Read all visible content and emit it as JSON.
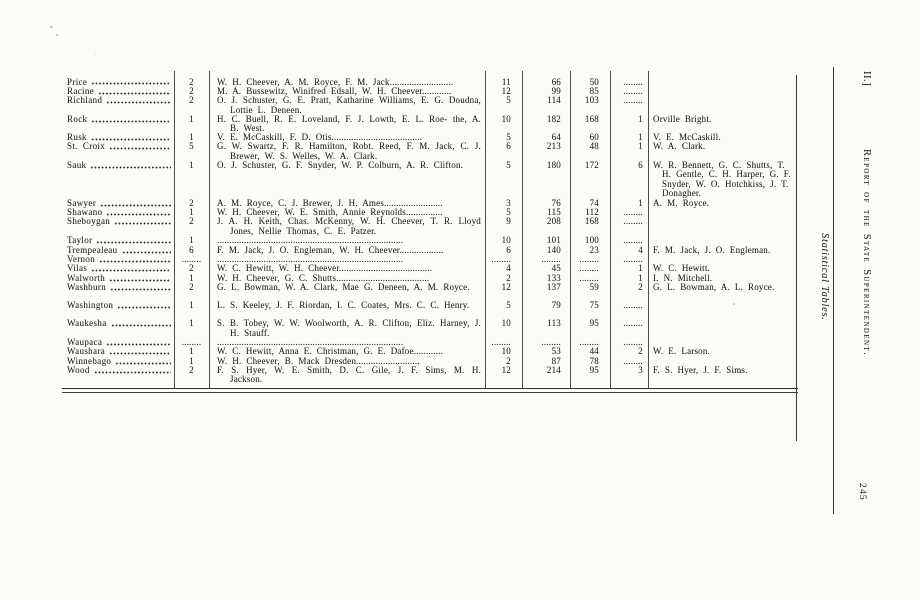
{
  "sidebar": {
    "volume_label": "II.]",
    "running_title": "Report of the State Superintendent.",
    "section_title": "Statistical Tables.",
    "page_number": "245"
  },
  "table": {
    "rows": [
      {
        "county": "Price",
        "count": "2",
        "names": "W. H. Cheever, A. M. Royce, F. M. Jack..........................",
        "v1": "11",
        "v2": "66",
        "v3": "50",
        "v4": "........",
        "appt": ""
      },
      {
        "county": "Racine",
        "count": "2",
        "names": "M. A. Bussewitz, Winifred Edsall, W. H. Cheever............",
        "v1": "12",
        "v2": "99",
        "v3": "85",
        "v4": "........",
        "appt": ""
      },
      {
        "county": "Richland",
        "count": "2",
        "names": "O. J. Schuster, G. E. Pratt, Katharine Williams, E. G. Doudna, Lottie L. Deneen.",
        "v1": "5",
        "v2": "114",
        "v3": "103",
        "v4": "........",
        "appt": ""
      },
      {
        "county": "Rock",
        "count": "1",
        "names": "H. C. Buell, R. E. Loveland, F. J. Lowth, E. L. Roe- the, A. B. West.",
        "v1": "10",
        "v2": "182",
        "v3": "168",
        "v4": "1",
        "appt": "Orville Bright."
      },
      {
        "county": "Rusk",
        "count": "1",
        "names": "V. E. McCaskill, F. D. Otis.....................................",
        "v1": "5",
        "v2": "64",
        "v3": "60",
        "v4": "1",
        "appt": "V. E. McCaskill."
      },
      {
        "county": "St. Croix",
        "count": "5",
        "names": "G. W. Swartz, F. R. Hamilton, Robt. Reed, F. M. Jack, C. J. Brewer, W. S. Welles, W. A. Clark.",
        "v1": "6",
        "v2": "213",
        "v3": "48",
        "v4": "1",
        "appt": "W. A. Clark."
      },
      {
        "county": "Sauk",
        "count": "1",
        "names": "O. J. Schuster, G. F. Snyder, W. P. Colburn, A. R. Clifton.",
        "v1": "5",
        "v2": "180",
        "v3": "172",
        "v4": "6",
        "appt": "W. R. Bennett, G. C. Shutts, T. H. Gentle, C. H. Harper, G. F. Snyder, W. O. Hotchkiss, J. T. Donagher."
      },
      {
        "county": "Sawyer",
        "count": "2",
        "names": "A. M. Royce, C. J. Brewer, J. H. Ames........................",
        "v1": "3",
        "v2": "76",
        "v3": "74",
        "v4": "1",
        "appt": "A. M. Royce."
      },
      {
        "county": "Shawano",
        "count": "1",
        "names": "W. H. Cheever, W. E. Smith, Annie Reynolds...............",
        "v1": "5",
        "v2": "115",
        "v3": "112",
        "v4": "........",
        "appt": ""
      },
      {
        "county": "Sheboygan",
        "count": "2",
        "names": "J. A. H. Keith, Chas. McKenny, W. H. Cheever, T. R. Lloyd Jones, Nellie Thomas, C. E. Patzer.",
        "v1": "9",
        "v2": "208",
        "v3": "168",
        "v4": "........",
        "appt": ""
      },
      {
        "county": "Taylor",
        "count": "1",
        "names": "............................................................................",
        "v1": "10",
        "v2": "101",
        "v3": "100",
        "v4": "........",
        "appt": ""
      },
      {
        "county": "Trempealeau",
        "count": "6",
        "names": "F. M. Jack, J. O. Engleman, W. H. Cheever..................",
        "v1": "6",
        "v2": "140",
        "v3": "23",
        "v4": "4",
        "appt": "F. M. Jack, J. O. Engleman."
      },
      {
        "county": "Vernon",
        "count": "........",
        "names": "............................................................................",
        "v1": "........",
        "v2": "........",
        "v3": "........",
        "v4": "........",
        "appt": ""
      },
      {
        "county": "Vilas",
        "count": "2",
        "names": "W. C. Hewitt, W. H. Cheever......................................",
        "v1": "4",
        "v2": "45",
        "v3": "........",
        "v4": "1",
        "appt": "W. C. Hewitt."
      },
      {
        "county": "Walworth",
        "count": "1",
        "names": "W. H. Cheever, G. C. Shutts......................................",
        "v1": "2",
        "v2": "133",
        "v3": "........",
        "v4": "1",
        "appt": "I. N. Mitchell."
      },
      {
        "county": "Washburn",
        "count": "2",
        "names": "G. L. Bowman, W. A. Clark, Mae G. Deneen, A. M. Royce.",
        "v1": "12",
        "v2": "137",
        "v3": "59",
        "v4": "2",
        "appt": "G. L. Bowman, A. L. Royce."
      },
      {
        "county": "Washington",
        "count": "1",
        "names": "L. S. Keeley, J. F. Riordan, I. C. Coates, Mrs. C. C. Henry.",
        "v1": "5",
        "v2": "79",
        "v3": "75",
        "v4": "........",
        "appt": ""
      },
      {
        "county": "Waukesha",
        "count": "1",
        "names": "S. B. Tobey, W. W. Woolworth, A. R. Clifton, Eliz. Harney, J. H. Stauff.",
        "v1": "10",
        "v2": "113",
        "v3": "95",
        "v4": "........",
        "appt": ""
      },
      {
        "county": "Waupaca",
        "count": "........",
        "names": "............................................................................",
        "v1": "........",
        "v2": "........",
        "v3": "........",
        "v4": "........",
        "appt": ""
      },
      {
        "county": "Waushara",
        "count": "1",
        "names": "W. C. Hewitt, Anna E. Christman, G. E. Dafoe............",
        "v1": "10",
        "v2": "53",
        "v3": "44",
        "v4": "2",
        "appt": "W. E. Larson."
      },
      {
        "county": "Winnebago",
        "count": "1",
        "names": "W. H. Cheever, B. Mack Dresden..........................",
        "v1": "2",
        "v2": "87",
        "v3": "78",
        "v4": "........",
        "appt": ""
      },
      {
        "county": "Wood",
        "count": "2",
        "names": "F. S. Hyer, W. E. Smith, D. C. Gile, J. F. Sims, M. H. Jackson.",
        "v1": "12",
        "v2": "214",
        "v3": "95",
        "v4": "3",
        "appt": "F. S. Hyer, J. F. Sims."
      }
    ]
  }
}
